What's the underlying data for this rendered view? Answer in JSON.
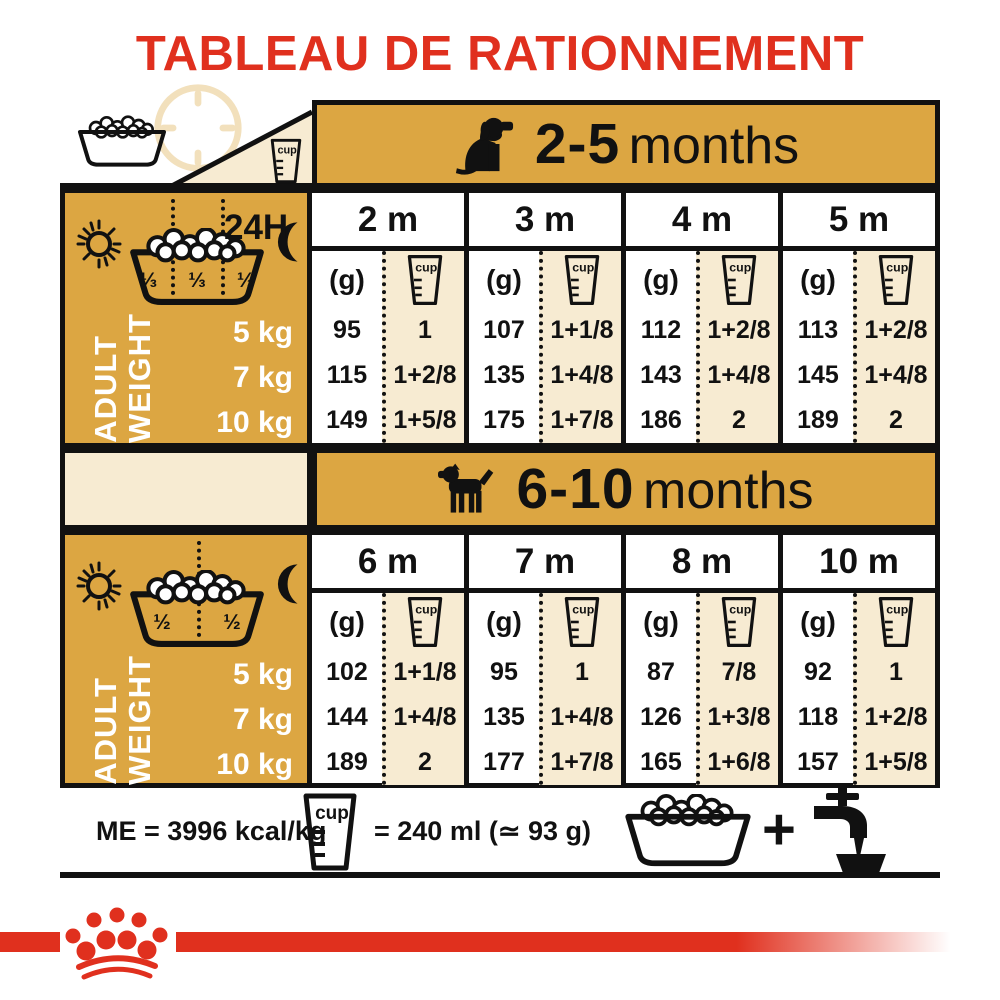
{
  "title": "TABLEAU DE RATIONNEMENT",
  "top_header": {
    "daily_label": "24H",
    "cup_label": "cup"
  },
  "cup_label": "cup",
  "tables": [
    {
      "age_bold": "2-5",
      "age_rest": "months",
      "columns": [
        "2 m",
        "3 m",
        "4 m",
        "5 m"
      ],
      "unit": "(g)",
      "bowl_fractions": [
        "⅓",
        "⅓",
        "⅓"
      ],
      "adult_weight_lines": [
        "ADULT",
        "WEIGHT"
      ],
      "weights": [
        "5 kg",
        "7 kg",
        "10 kg"
      ],
      "grams": [
        [
          95,
          115,
          149
        ],
        [
          107,
          135,
          175
        ],
        [
          112,
          143,
          186
        ],
        [
          113,
          145,
          189
        ]
      ],
      "cups": [
        [
          "1",
          "1+2/8",
          "1+5/8"
        ],
        [
          "1+1/8",
          "1+4/8",
          "1+7/8"
        ],
        [
          "1+2/8",
          "1+4/8",
          "2"
        ],
        [
          "1+2/8",
          "1+4/8",
          "2"
        ]
      ]
    },
    {
      "age_bold": "6-10",
      "age_rest": "months",
      "columns": [
        "6 m",
        "7 m",
        "8 m",
        "10 m"
      ],
      "unit": "(g)",
      "bowl_fractions": [
        "½",
        "½"
      ],
      "adult_weight_lines": [
        "ADULT",
        "WEIGHT"
      ],
      "weights": [
        "5 kg",
        "7 kg",
        "10 kg"
      ],
      "grams": [
        [
          102,
          144,
          189
        ],
        [
          95,
          135,
          177
        ],
        [
          87,
          126,
          165
        ],
        [
          92,
          118,
          157
        ]
      ],
      "cups": [
        [
          "1+1/8",
          "1+4/8",
          "2"
        ],
        [
          "1",
          "1+4/8",
          "1+7/8"
        ],
        [
          "7/8",
          "1+3/8",
          "1+6/8"
        ],
        [
          "1",
          "1+2/8",
          "1+5/8"
        ]
      ]
    }
  ],
  "legend": {
    "me": "ME = 3996 kcal/kg",
    "cup_equals": "= 240 ml (≃ 93 g)",
    "plus": "+"
  },
  "colors": {
    "gold": "#DCA642",
    "cream": "#F7EBD2",
    "red": "#E0301E"
  }
}
